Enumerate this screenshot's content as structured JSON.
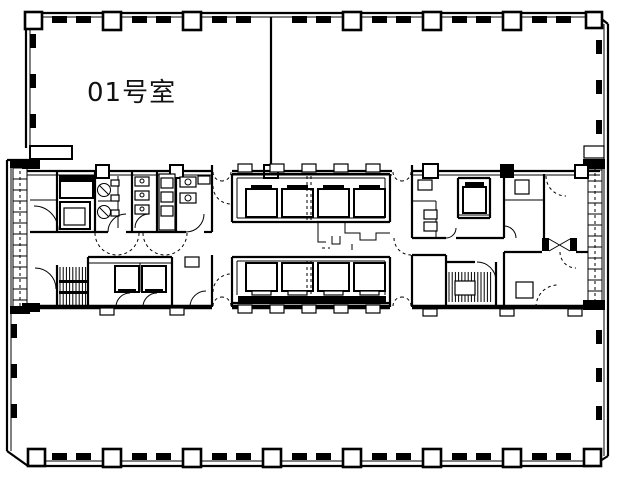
{
  "floor_plan": {
    "room_label": "01号室",
    "line_color": "#000000",
    "background_color": "#ffffff"
  }
}
